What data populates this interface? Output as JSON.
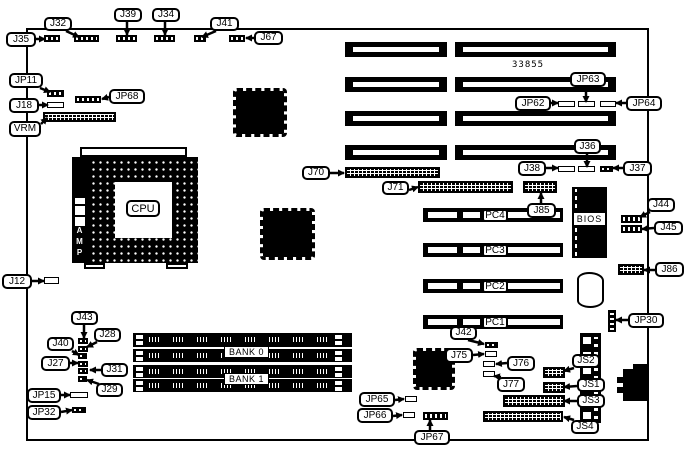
{
  "diagram": {
    "board_number": "33855",
    "cpu": "CPU",
    "amp": "AMP",
    "bios": "BIOS",
    "callouts": [
      {
        "t": "J32",
        "b": [
          44,
          17,
          28,
          14
        ],
        "l": [
          66,
          31,
          79,
          37
        ]
      },
      {
        "t": "J39",
        "b": [
          114,
          8,
          28,
          14
        ],
        "l": [
          127,
          22,
          127,
          35
        ]
      },
      {
        "t": "J34",
        "b": [
          152,
          8,
          28,
          14
        ],
        "l": [
          165,
          22,
          165,
          35
        ]
      },
      {
        "t": "J41",
        "b": [
          210,
          17,
          29,
          14
        ],
        "l": [
          216,
          31,
          202,
          37
        ]
      },
      {
        "t": "J67",
        "b": [
          254,
          31,
          29,
          14
        ],
        "l": [
          254,
          38,
          246,
          38
        ]
      },
      {
        "t": "J35",
        "b": [
          6,
          32,
          30,
          15
        ],
        "l": [
          36,
          39,
          45,
          39
        ]
      },
      {
        "t": "JP11",
        "b": [
          9,
          73,
          34,
          15
        ],
        "l": [
          40,
          88,
          50,
          92
        ]
      },
      {
        "t": "J18",
        "b": [
          9,
          98,
          30,
          15
        ],
        "l": [
          39,
          105,
          48,
          105
        ]
      },
      {
        "t": "JP68",
        "b": [
          109,
          89,
          36,
          15
        ],
        "l": [
          109,
          97,
          102,
          99
        ]
      },
      {
        "t": "VRM",
        "b": [
          9,
          121,
          32,
          16
        ],
        "l": [
          41,
          124,
          47,
          118
        ]
      },
      {
        "t": "J12",
        "b": [
          2,
          274,
          30,
          15
        ],
        "l": [
          32,
          281,
          44,
          281
        ]
      },
      {
        "t": "J43",
        "b": [
          71,
          311,
          27,
          14
        ],
        "l": [
          84,
          325,
          84,
          338
        ]
      },
      {
        "t": "J28",
        "b": [
          94,
          328,
          27,
          14
        ],
        "l": [
          97,
          342,
          87,
          347
        ]
      },
      {
        "t": "J40",
        "b": [
          47,
          337,
          27,
          14
        ],
        "l": [
          72,
          351,
          79,
          355
        ]
      },
      {
        "t": "J27",
        "b": [
          41,
          356,
          29,
          15
        ],
        "l": [
          70,
          363,
          78,
          363
        ]
      },
      {
        "t": "J31",
        "b": [
          101,
          363,
          27,
          14
        ],
        "l": [
          101,
          370,
          90,
          370
        ]
      },
      {
        "t": "J29",
        "b": [
          96,
          383,
          27,
          14
        ],
        "l": [
          99,
          384,
          87,
          380
        ]
      },
      {
        "t": "JP15",
        "b": [
          27,
          388,
          34,
          15
        ],
        "l": [
          61,
          395,
          70,
          395
        ]
      },
      {
        "t": "JP32",
        "b": [
          27,
          405,
          34,
          15
        ],
        "l": [
          61,
          412,
          72,
          410
        ]
      },
      {
        "t": "J70",
        "b": [
          302,
          166,
          28,
          14
        ],
        "l": [
          330,
          173,
          344,
          173
        ]
      },
      {
        "t": "J71",
        "b": [
          382,
          181,
          27,
          14
        ],
        "l": [
          409,
          190,
          418,
          187
        ]
      },
      {
        "t": "J85",
        "b": [
          527,
          203,
          29,
          15
        ],
        "l": [
          541,
          203,
          541,
          193
        ]
      },
      {
        "t": "JP63",
        "b": [
          570,
          72,
          36,
          15
        ],
        "l": [
          586,
          87,
          586,
          102
        ]
      },
      {
        "t": "JP62",
        "b": [
          515,
          96,
          36,
          15
        ],
        "l": [
          551,
          103,
          558,
          103
        ]
      },
      {
        "t": "JP64",
        "b": [
          626,
          96,
          36,
          15
        ],
        "l": [
          626,
          103,
          616,
          103
        ]
      },
      {
        "t": "J36",
        "b": [
          574,
          139,
          27,
          15
        ],
        "l": [
          587,
          154,
          587,
          167
        ]
      },
      {
        "t": "J38",
        "b": [
          518,
          161,
          28,
          15
        ],
        "l": [
          546,
          168,
          558,
          168
        ]
      },
      {
        "t": "J37",
        "b": [
          623,
          161,
          29,
          15
        ],
        "l": [
          623,
          168,
          613,
          168
        ]
      },
      {
        "t": "J44",
        "b": [
          647,
          198,
          28,
          14
        ],
        "l": [
          650,
          212,
          640,
          217
        ]
      },
      {
        "t": "J45",
        "b": [
          654,
          221,
          29,
          14
        ],
        "l": [
          654,
          228,
          642,
          229
        ]
      },
      {
        "t": "J86",
        "b": [
          655,
          262,
          29,
          15
        ],
        "l": [
          655,
          270,
          644,
          270
        ]
      },
      {
        "t": "JP30",
        "b": [
          628,
          313,
          36,
          15
        ],
        "l": [
          628,
          320,
          616,
          320
        ]
      },
      {
        "t": "J42",
        "b": [
          450,
          326,
          27,
          14
        ],
        "l": [
          468,
          340,
          484,
          344
        ]
      },
      {
        "t": "J75",
        "b": [
          445,
          348,
          28,
          15
        ],
        "l": [
          473,
          355,
          484,
          354
        ]
      },
      {
        "t": "J76",
        "b": [
          507,
          356,
          28,
          15
        ],
        "l": [
          507,
          363,
          496,
          364
        ]
      },
      {
        "t": "J77",
        "b": [
          497,
          377,
          28,
          15
        ],
        "l": [
          501,
          377,
          494,
          376
        ]
      },
      {
        "t": "JS2",
        "b": [
          572,
          354,
          28,
          14
        ],
        "l": [
          574,
          368,
          564,
          371
        ]
      },
      {
        "t": "JS1",
        "b": [
          577,
          378,
          28,
          14
        ],
        "l": [
          577,
          386,
          564,
          387
        ]
      },
      {
        "t": "JS3",
        "b": [
          577,
          394,
          28,
          14
        ],
        "l": [
          577,
          401,
          564,
          401
        ]
      },
      {
        "t": "JS4",
        "b": [
          571,
          420,
          28,
          14
        ],
        "l": [
          574,
          420,
          564,
          417
        ]
      },
      {
        "t": "JP65",
        "b": [
          359,
          392,
          36,
          15
        ],
        "l": [
          395,
          400,
          404,
          399
        ]
      },
      {
        "t": "JP66",
        "b": [
          357,
          408,
          36,
          15
        ],
        "l": [
          393,
          416,
          402,
          415
        ]
      },
      {
        "t": "JP67",
        "b": [
          414,
          430,
          36,
          15
        ],
        "l": [
          430,
          430,
          430,
          420
        ]
      }
    ],
    "slot_labels": [
      {
        "t": "PC4",
        "k": "pc",
        "b": [
          482,
          209,
          26,
          13
        ]
      },
      {
        "t": "PC3",
        "k": "pc",
        "b": [
          482,
          244,
          26,
          13
        ]
      },
      {
        "t": "PC2",
        "k": "pc",
        "b": [
          482,
          280,
          26,
          13
        ]
      },
      {
        "t": "PC1",
        "k": "pc",
        "b": [
          482,
          316,
          26,
          13
        ]
      },
      {
        "t": "BANK 0",
        "k": "bank",
        "b": [
          224,
          346,
          45,
          12
        ]
      },
      {
        "t": "BANK 1",
        "k": "bank",
        "b": [
          224,
          373,
          45,
          12
        ]
      }
    ]
  }
}
